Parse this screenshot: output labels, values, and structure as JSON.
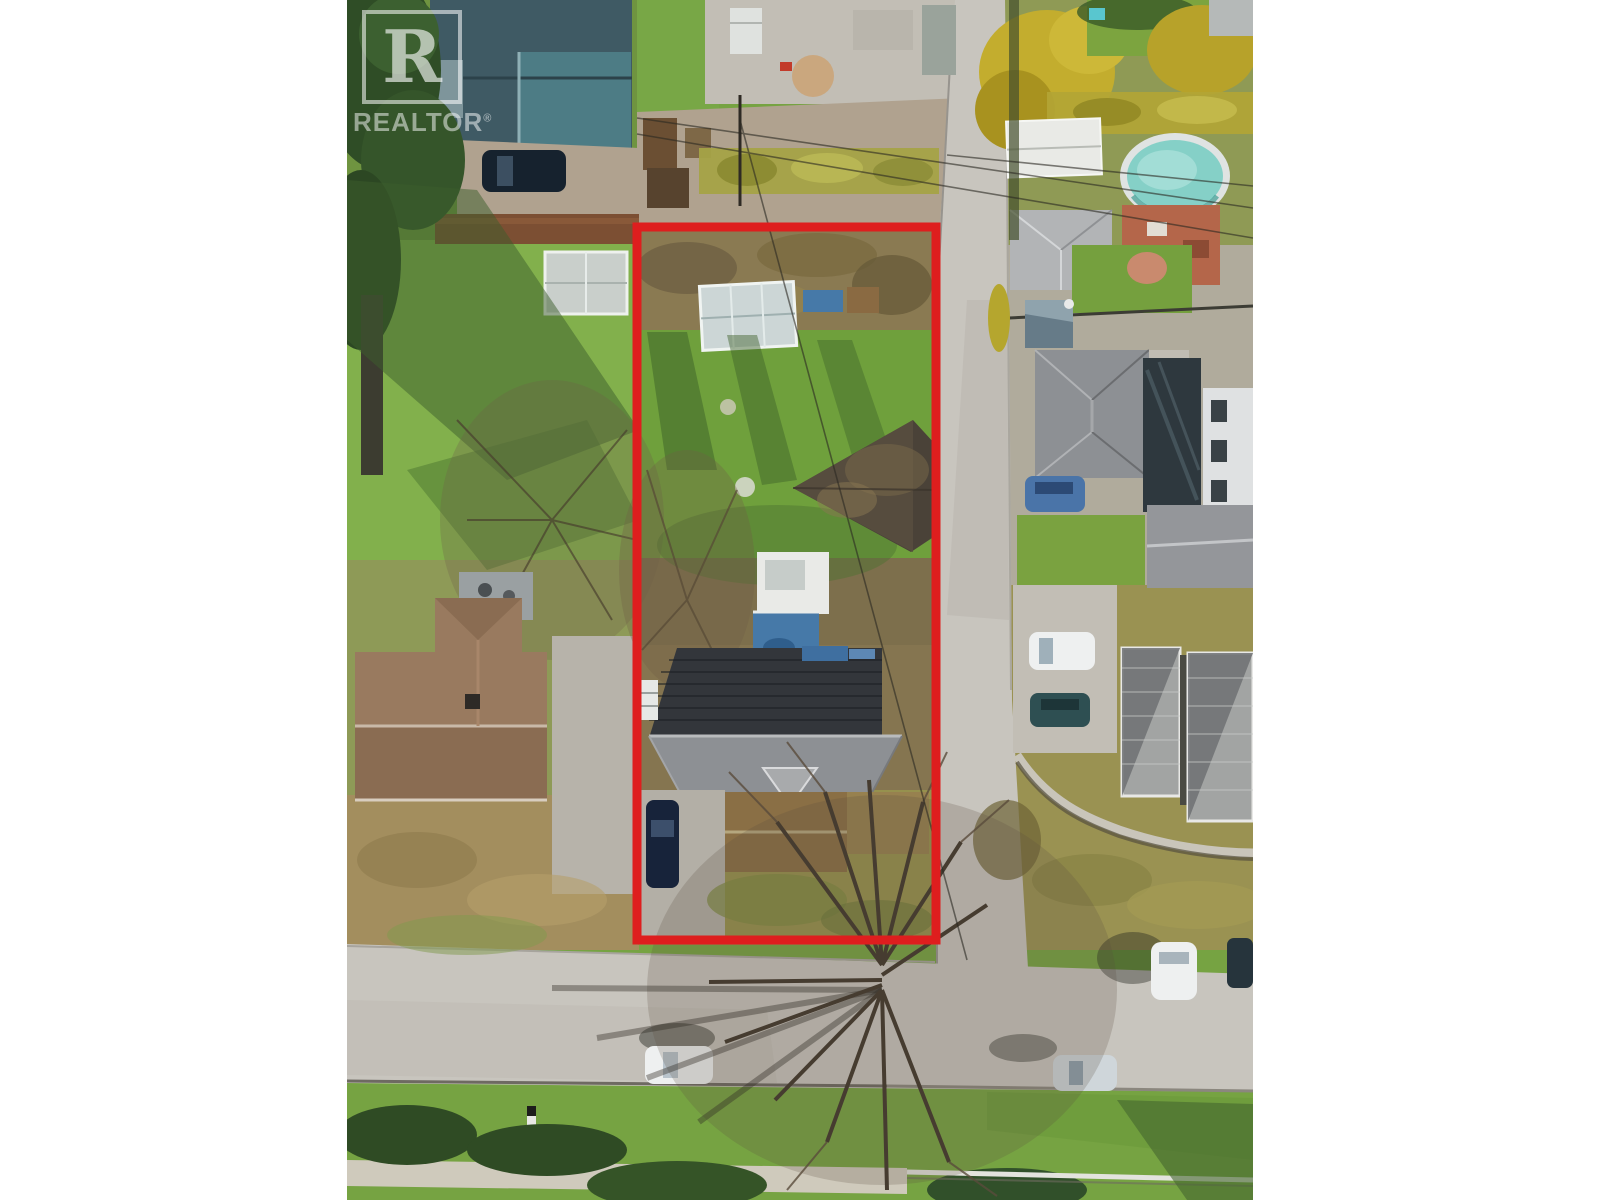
{
  "watermark": {
    "logo_letter": "R",
    "brand": "REALTOR",
    "registered": "®"
  },
  "boundary": {
    "label": "subject-property-outline",
    "color": "#de1e1e"
  },
  "palette": {
    "lawn_green": "#76a342",
    "lawn_bright": "#82b04c",
    "lawn_olive": "#96914e",
    "scrub_brown": "#8a7a52",
    "leaf_brown": "#a38e5e",
    "road_gray": "#c8c5be",
    "concrete": "#c2beb5",
    "gravel": "#b0a28f",
    "roof_dark": "#33363b",
    "roof_gray": "#8d9094",
    "roof_light": "#b2b4b6",
    "roof_brown": "#997a5f",
    "roof_ribbed": "#a2a4a3",
    "roof_teal": "#3f5a64",
    "pool_water": "#85d0c7",
    "tarp_blue": "#4679a8",
    "white_structure": "#e9eae7",
    "hedge_dark": "#2f4b24",
    "tree_yellow": "#c3ad2e",
    "shadow_green": "#3c5e2b",
    "terracotta": "#b4664a",
    "car_dark_blue": "#17233a",
    "car_white": "#eef0f0"
  }
}
